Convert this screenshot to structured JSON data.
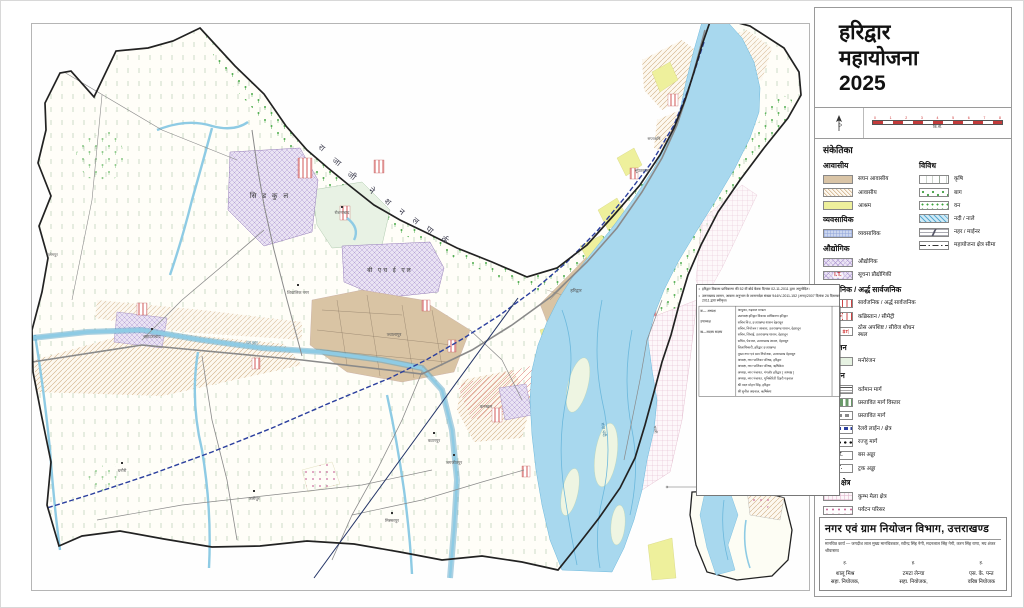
{
  "panel": {
    "title": {
      "line1": "हरिद्वार",
      "line2": "महायोजना",
      "line3": "2025"
    },
    "scale": {
      "ticks": [
        "0",
        "1",
        "2",
        "3",
        "4",
        "5",
        "6",
        "7",
        "8"
      ],
      "unit": "कि.मी."
    },
    "legend_title": "संकेतिका",
    "legend": {
      "columns": [
        {
          "sections": [
            {
              "title": "आवासीय",
              "items": [
                {
                  "label": "सघन आवासीय",
                  "swatch": "s-tan"
                },
                {
                  "label": "आवासीय",
                  "swatch": "s-hatchtan"
                },
                {
                  "label": "आश्रम",
                  "swatch": "s-yellow"
                }
              ]
            },
            {
              "title": "व्यवसायिक",
              "items": [
                {
                  "label": "व्यवसायिक",
                  "swatch": "s-gridblue"
                }
              ]
            },
            {
              "title": "औद्योगिक",
              "items": [
                {
                  "label": "औद्योगिक",
                  "swatch": "s-crosspurple"
                },
                {
                  "label": "सूचना प्रौद्योगिकी",
                  "swatch": "s-crosspurple",
                  "tag": "I.T.",
                  "tag_color": "#c22"
                }
              ]
            },
            {
              "title": "सार्वजनिक / अर्द्ध सार्वजनिक",
              "items": [
                {
                  "label": "सार्वजनिक / अर्द्ध सार्वजनिक",
                  "swatch": "s-stripered"
                },
                {
                  "label": "कब्रिस्तान / सीमेट्री",
                  "swatch": "s-stripered",
                  "tag": "BG",
                  "tag_color": "#c22"
                },
                {
                  "label": "ठोस अपशिष्ट / सीवेज शोधन स्थल",
                  "swatch": "two",
                  "tags": [
                    "SW",
                    "ST"
                  ],
                  "tag_color": "#c22"
                }
              ]
            },
            {
              "title": "मनोरंजन",
              "items": [
                {
                  "label": "मनोरंजन",
                  "swatch": "s-palegreen"
                }
              ]
            },
            {
              "title": "परिवहन",
              "items": [
                {
                  "label": "वर्तमान मार्ग",
                  "swatch": "s-linesh"
                },
                {
                  "label": "प्रस्तावित मार्ग विस्तार",
                  "swatch": "s-dashgreen"
                },
                {
                  "label": "प्रस्तावित मार्ग",
                  "swatch": "s-dashbox"
                },
                {
                  "label": "रेलवे लाईन / क्षेत्र",
                  "swatch": "s-rail"
                },
                {
                  "label": "रज्जु मार्ग",
                  "swatch": "s-dots"
                },
                {
                  "label": "बस अड्डा",
                  "swatch": "",
                  "tag": "B.T.",
                  "tag_color": "#111"
                },
                {
                  "label": "ट्रक अड्डा",
                  "swatch": "",
                  "tag": "T.T.",
                  "tag_color": "#111"
                }
              ]
            },
            {
              "title": "विशेष क्षेत्र",
              "items": [
                {
                  "label": "कुम्भ मेला क्षेत्र",
                  "swatch": "s-gridpink"
                },
                {
                  "label": "पर्यटन परिसर",
                  "swatch": "s-dotspink"
                }
              ]
            }
          ]
        },
        {
          "sections": [
            {
              "title": "विविध",
              "items": [
                {
                  "label": "कृषि",
                  "swatch": "s-agri"
                },
                {
                  "label": "बाग",
                  "swatch": "s-orchard"
                },
                {
                  "label": "वन",
                  "swatch": "s-forest"
                },
                {
                  "label": "नदी / नाले",
                  "swatch": "s-riverhatch"
                },
                {
                  "label": "नहर / माईनर",
                  "swatch": "s-canal"
                },
                {
                  "label": "महायोजना क्षेत्र सीमा",
                  "swatch": "s-boundary"
                }
              ]
            }
          ]
        }
      ]
    },
    "dept": {
      "title": "नगर एवं ग्राम नियोजन विभाग, उत्तराखण्ड",
      "credits": "मानचित्र कार्य — जगदीश लाल मुख्य मानचित्रकार, रवीन्द्र सिंह नेगी, मदनलाल सिंह नेगी, करन सिंह राणा, मय शंकर श्रीवास्तव",
      "signatories": [
        {
          "mark": "ह.",
          "name": "शालू मिश्र",
          "role": "सहा. नियोजक,"
        },
        {
          "mark": "ह.",
          "name": "टमटा लेन्चा",
          "role": "सहा. नियोजक,"
        },
        {
          "mark": "ह.",
          "name": "एस. के. पन्त",
          "role": "वरिष्ठ नियोजक"
        }
      ]
    }
  },
  "notes": {
    "bullets": [
      "हरिद्वार विकास प्राधिकरण की 52 वीं बोर्ड बैठक दिनांक 02-11-2011 द्वारा अनुमोदित।",
      "उत्तराखण्ड शासन, आवास अनुभाग के शासनादेश संख्या 944/V-2011-152 (अना)/2007 दिनांक 26 दिसम्बर 2011 द्वारा स्वीकृत।"
    ],
    "table": {
      "left": [
        "क— अध्यक्ष",
        "उपाध्यक्ष",
        "ख—सदस्य सदस्य"
      ],
      "rows": [
        "आयुक्त, गढ़वाल मण्डल",
        "उपाध्यक्ष हरिद्वार विकास प्राधिकरण हरिद्वार",
        "सचिव वित्त, उत्तराखण्ड शासन देहरादून",
        "सचिव, नियोजन / आवास, उत्तराखण्ड शासन, देहरादून",
        "सचिव, सिंचाई, उत्तराखण्ड शासन, देहरादून",
        "सचिव, पेयजल, उत्तराखण्ड शासन, देहरादून",
        "जिलाधिकारी, हरिद्वार उत्तराखण्ड",
        "मुख्य नगर एवं ग्राम नियोजक, उत्तराखण्ड देहरादून",
        "अध्यक्ष, नगर पालिका परिषद, हरिद्वार",
        "अध्यक्ष, नगर पालिका परिषद, ऋषिकेश",
        "अध्यक्ष, नगर पंचायत, मंगलौर हरिद्वार ( अध्यक्ष )",
        "अध्यक्ष, नगर पंचायत, मुनिकीरेती टिहरी गढ़वाल",
        "श्री मदन मोहन सिंह, हरिद्वार",
        "श्री सुनील अग्रवाल, ऋषिकेश"
      ]
    }
  },
  "map": {
    "park_letters": [
      "रा",
      "जा",
      "जी",
      "ने",
      "श",
      "न",
      "ल",
      "पा",
      "र्क"
    ],
    "zone_labels": [
      {
        "t": "सि  ड  कु  ल",
        "x": 268,
        "y": 198,
        "s": 7,
        "c": "#333"
      },
      {
        "t": "बी  एच  ई  एल",
        "x": 388,
        "y": 272,
        "s": 6,
        "c": "#333"
      }
    ],
    "labels": [
      {
        "t": "बहादराबाद",
        "x": 150,
        "y": 338,
        "s": 4.4
      },
      {
        "t": "रोशनाबाद",
        "x": 340,
        "y": 214,
        "s": 4.2
      },
      {
        "t": "शिवालिक नगर",
        "x": 296,
        "y": 294,
        "s": 4.2
      },
      {
        "t": "ज्वालापुर",
        "x": 392,
        "y": 336,
        "s": 4.4
      },
      {
        "t": "हरिद्वार",
        "x": 574,
        "y": 292,
        "s": 4.6
      },
      {
        "t": "कनखल",
        "x": 484,
        "y": 408,
        "s": 4.4
      },
      {
        "t": "जगजीतपुर",
        "x": 452,
        "y": 464,
        "s": 4.2
      },
      {
        "t": "भूपतवाला",
        "x": 640,
        "y": 172,
        "s": 4.2
      },
      {
        "t": "सप्तऋषि",
        "x": 652,
        "y": 140,
        "s": 4
      },
      {
        "t": "गंगा नदी",
        "x": 600,
        "y": 430,
        "s": 4.6,
        "r": 80,
        "c": "#3a7da0"
      },
      {
        "t": "गंग नहर",
        "x": 250,
        "y": 344,
        "s": 4,
        "c": "#3a7da0"
      },
      {
        "t": "धनौरी",
        "x": 120,
        "y": 472,
        "s": 4.2
      },
      {
        "t": "सलेमपुर",
        "x": 50,
        "y": 256,
        "s": 4
      },
      {
        "t": "पथरी",
        "x": 652,
        "y": 430,
        "s": 4,
        "r": 80
      },
      {
        "t": "मिस्सरपुर",
        "x": 390,
        "y": 522,
        "s": 4.2
      },
      {
        "t": "अलीपुर",
        "x": 252,
        "y": 500,
        "s": 4.2
      },
      {
        "t": "कटारपुर",
        "x": 432,
        "y": 442,
        "s": 4.2
      }
    ]
  }
}
